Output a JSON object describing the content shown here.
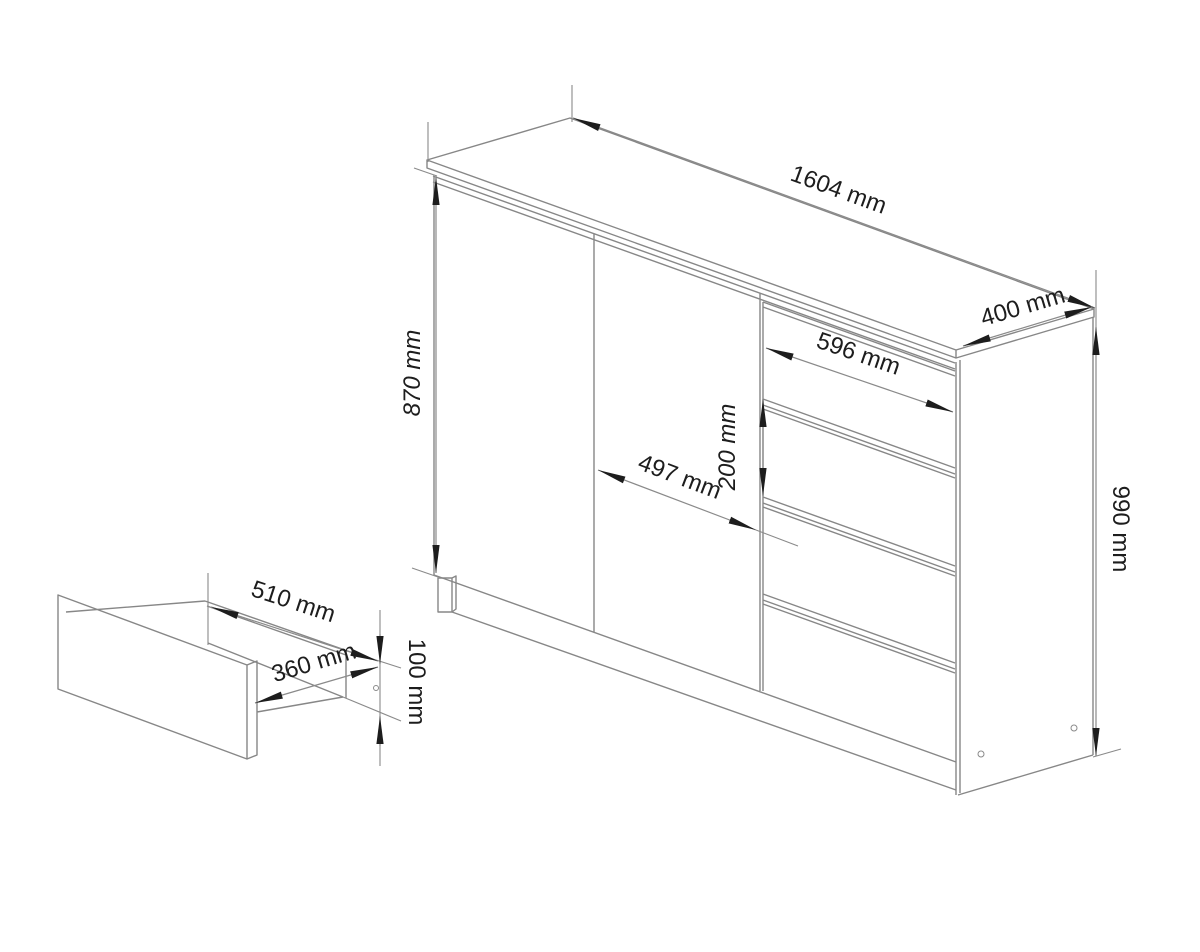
{
  "cabinet": {
    "width_label": "1604 mm",
    "depth_label": "400 mm",
    "height_label": "990 mm",
    "door_height_label": "870 mm",
    "door_width_label": "497 mm",
    "drawer_front_width_label": "596 mm",
    "drawer_front_height_label": "200 mm"
  },
  "drawer_box": {
    "depth_label": "510 mm",
    "width_label": "360 mm",
    "height_label": "100 mm"
  },
  "colors": {
    "furniture_line": "#878787",
    "dimension_line": "#8a8a8a",
    "ink": "#1d1d1d",
    "background": "#ffffff"
  }
}
